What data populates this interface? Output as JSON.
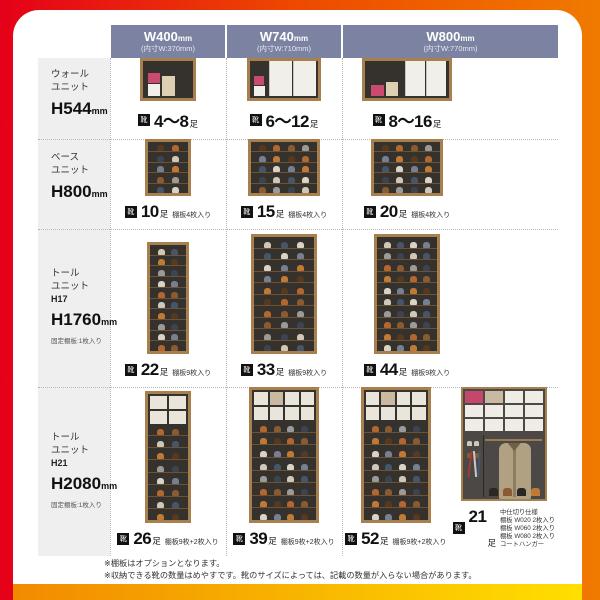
{
  "colors": {
    "edge_left": "#e50019",
    "edge_right": "#f07a00",
    "header_bg": "#7b82a2",
    "bar_from": "#f28a00",
    "bar_to": "#ffdf00",
    "accent_pink": "#cb4a70",
    "wood": "#a8804f"
  },
  "icons": {
    "shoe": "靴"
  },
  "header": {
    "cols": [
      {
        "size": "W400",
        "unit": "mm",
        "inner": "(内寸W:370mm)"
      },
      {
        "size": "W740",
        "unit": "mm",
        "inner": "(内寸W:710mm)"
      },
      {
        "size": "W800",
        "unit": "mm",
        "inner": "(内寸W:770mm)"
      }
    ]
  },
  "rows": [
    {
      "label_lines": [
        "ウォール",
        "ユニット"
      ],
      "height": "H544",
      "height_unit": "mm",
      "fixed_note": "",
      "cells": [
        {
          "count": "4〜8",
          "unit": "足",
          "note": ""
        },
        {
          "count": "6〜12",
          "unit": "足",
          "note": ""
        },
        {
          "count": "8〜16",
          "unit": "足",
          "note": ""
        }
      ]
    },
    {
      "label_lines": [
        "ベース",
        "ユニット"
      ],
      "height": "H800",
      "height_unit": "mm",
      "fixed_note": "",
      "cells": [
        {
          "count": "10",
          "unit": "足",
          "note": "棚板4枚入り"
        },
        {
          "count": "15",
          "unit": "足",
          "note": "棚板4枚入り"
        },
        {
          "count": "20",
          "unit": "足",
          "note": "棚板4枚入り"
        }
      ]
    },
    {
      "label_lines": [
        "トール",
        "ユニット"
      ],
      "model": "H17",
      "height": "H1760",
      "height_unit": "mm",
      "fixed_note": "固定棚板:1枚入り",
      "cells": [
        {
          "count": "22",
          "unit": "足",
          "note": "棚板9枚入り"
        },
        {
          "count": "33",
          "unit": "足",
          "note": "棚板9枚入り"
        },
        {
          "count": "44",
          "unit": "足",
          "note": "棚板9枚入り"
        }
      ]
    },
    {
      "label_lines": [
        "トール",
        "ユニット"
      ],
      "model": "H21",
      "height": "H2080",
      "height_unit": "mm",
      "fixed_note": "固定棚板:1枚入り",
      "cells": [
        {
          "count": "26",
          "unit": "足",
          "note": "棚板9枚+2枚入り"
        },
        {
          "count": "39",
          "unit": "足",
          "note": "棚板9枚+2枚入り"
        },
        {
          "count": "52",
          "unit": "足",
          "note": "棚板9枚+2枚入り"
        },
        {
          "count": "21",
          "unit": "足",
          "note_lines": [
            "中仕切り仕様",
            "棚板 W020 2枚入り",
            "棚板 W060 2枚入り",
            "棚板 W080 2枚入り",
            "コートハンガー"
          ]
        }
      ]
    }
  ],
  "footnotes": [
    "※棚板はオプションとなります。",
    "※収納できる靴の数量はめやすです。靴のサイズによっては、記載の数量が入らない場合があります。"
  ]
}
